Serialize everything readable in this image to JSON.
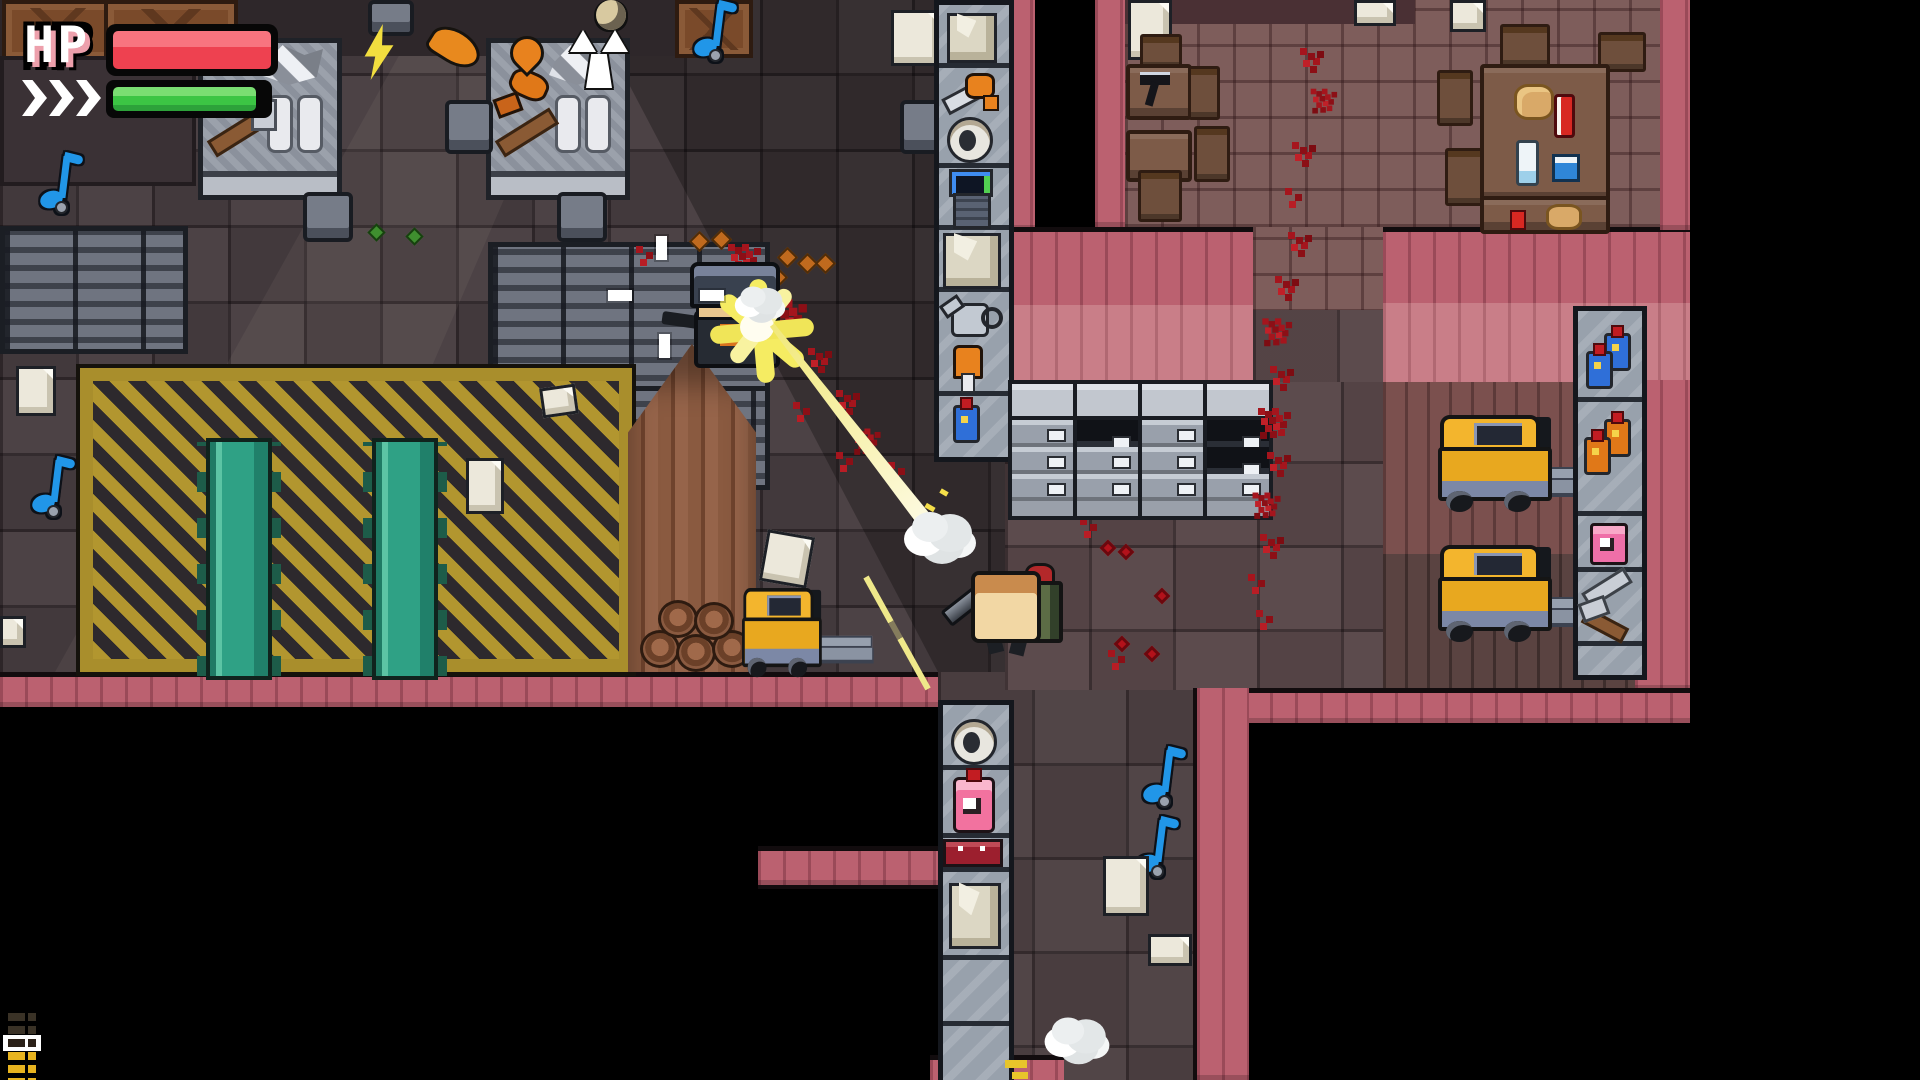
{
  "hud": {
    "hp_label": "HP",
    "health_bar": {
      "fill_pct": 100,
      "fill_color": "#ee4150"
    },
    "energy_bar": {
      "fill_pct": 94,
      "fill_color": "#3cc544"
    },
    "dash_chevrons": 3,
    "ammo_pips": [
      "spent",
      "spent",
      "selected",
      "full",
      "full",
      "full"
    ],
    "colors": {
      "pip_full": "#e8b41f",
      "pip_spent": "#3a3226",
      "pip_selected": "#2b2118",
      "chevron": "#ffffff",
      "chevron_outline": "#2e8f33",
      "hp_text": "#ffffff",
      "hp_text_shade": "#eda0ac"
    }
  },
  "scene": {
    "setting": "top-down pixel-art warehouse and cafeteria level",
    "rooms": [
      {
        "name": "factory-floor",
        "floor": "dark gray tiles with hazard zone"
      },
      {
        "name": "cafeteria",
        "floor": "mauve tiles, pink plank walls"
      },
      {
        "name": "warehouse-floor",
        "floor": "warm dark tiles and wood planks"
      },
      {
        "name": "south-corridor",
        "floor": "dark tiles between pink walls"
      }
    ],
    "characters": [
      {
        "name": "player",
        "description": "tan-headed character with green backpack holding a gray gun, aiming up-left"
      },
      {
        "name": "enemy-soldier",
        "description": "helmeted enemy firing a weapon, engulfed in muzzle flash and blood"
      }
    ],
    "effects": [
      {
        "name": "crosshair",
        "ticks": 4,
        "color": "#ffffff"
      },
      {
        "name": "muzzle-flash",
        "color": "#f5ec62"
      },
      {
        "name": "bullet-tracer",
        "count": 2,
        "color": "#f5ec62"
      },
      {
        "name": "smoke-puff",
        "count": 3,
        "color": "#eceff0"
      },
      {
        "name": "blood-splatter",
        "count": "many",
        "color": "#a5151d"
      },
      {
        "name": "bullet-casing",
        "count": 6,
        "color": "#c06a1e"
      },
      {
        "name": "shell-casing-green",
        "count": 2,
        "color": "#3f8f2f"
      }
    ],
    "props": [
      {
        "name": "workbench",
        "count": 2,
        "items": [
          "hammer",
          "metal plates",
          "scrap metal",
          "orange tool"
        ]
      },
      {
        "name": "conveyor-belt",
        "count": 2,
        "color": "#2fa185"
      },
      {
        "name": "hazard-floor-zone",
        "stripe_colors": [
          "#b2962f",
          "#2d292d"
        ]
      },
      {
        "name": "lumber-pile",
        "count": 1
      },
      {
        "name": "forklift",
        "count": 3,
        "color": "#f0b429"
      },
      {
        "name": "filing-cabinet",
        "count": 4
      },
      {
        "name": "locker-bank",
        "count": 3
      },
      {
        "name": "wooden-crate",
        "count": 3
      },
      {
        "name": "stool",
        "count": 5
      },
      {
        "name": "storage-shelf-east",
        "items": [
          "paper box",
          "axe",
          "mug",
          "computer terminal",
          "paper box",
          "watering can",
          "orange tool",
          "blue bottle"
        ]
      },
      {
        "name": "storage-shelf-corridor",
        "items": [
          "mug",
          "pink sauce bottle",
          "red case",
          "paper box"
        ]
      },
      {
        "name": "storage-shelf-right",
        "items": [
          "blue bottle",
          "blue bottle",
          "orange bottle",
          "orange bottle",
          "pink jar",
          "metal tool",
          "metal tool"
        ]
      },
      {
        "name": "cafeteria-furniture",
        "tables": 4,
        "chairs": 8,
        "table_items": [
          "desk lamp",
          "bread loaf",
          "ketchup bottle",
          "milk bottle",
          "blue cup",
          "bread loaf"
        ]
      },
      {
        "name": "pickup-music-note",
        "count": 4,
        "color": "#2196e8"
      },
      {
        "name": "pickup-paper",
        "count": 10
      },
      {
        "name": "weapon-sprite-lightning",
        "color": "#f2de3f"
      },
      {
        "name": "weapon-sprite-drumstick",
        "color": "#e8891e"
      },
      {
        "name": "weapon-sprite-flame",
        "color": "#e8821e"
      },
      {
        "name": "weapon-sprite-trophy",
        "color": "#ffffff"
      }
    ],
    "palette": {
      "void": "#000000",
      "wall_pink": "#bb6170",
      "wall_pink_light": "#c97e88",
      "floor_factory": "#463c3f",
      "floor_warm": "#584749",
      "floor_cafe": "#7e5d5b",
      "hazard_yellow": "#b2962f",
      "conveyor_teal": "#2fa185",
      "forklift_yellow": "#f0b429",
      "blood_red": "#a5151d",
      "tracer_yellow": "#f5ec62",
      "note_blue": "#2196e8"
    }
  }
}
